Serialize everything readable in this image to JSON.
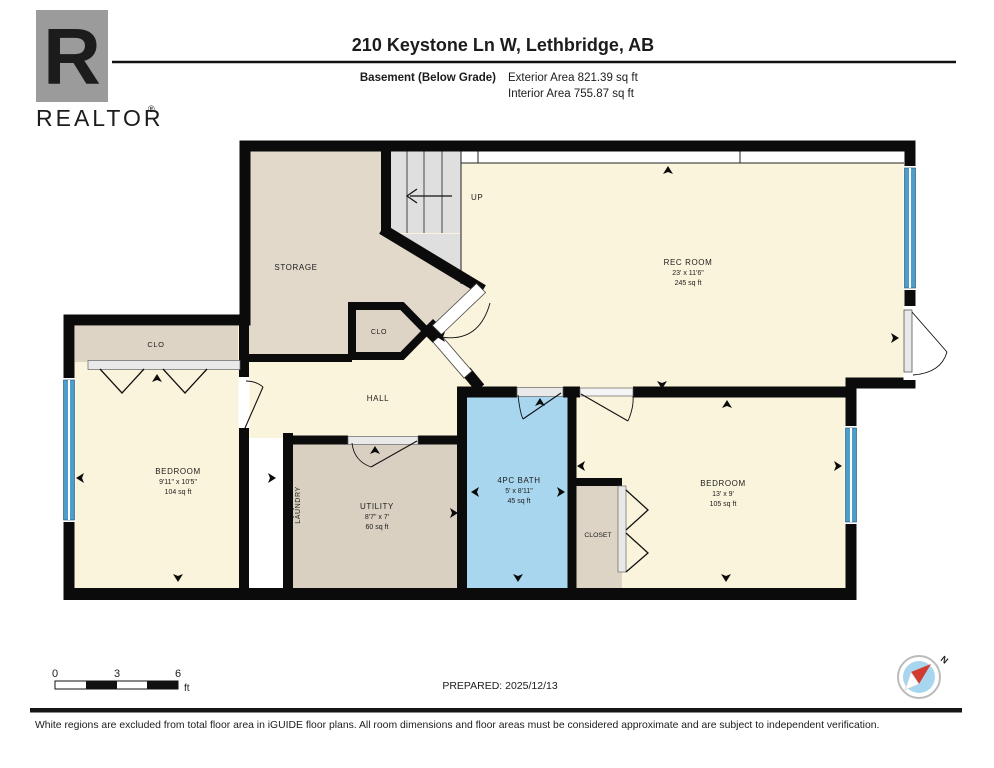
{
  "header": {
    "logo_letter": "R",
    "logo_brand": "REALTOR",
    "logo_registered": "®",
    "title": "210 Keystone Ln W, Lethbridge, AB",
    "floor_label": "Basement (Below Grade)",
    "exterior_area": "Exterior Area 821.39 sq ft",
    "interior_area": "Interior Area 755.87 sq ft"
  },
  "plan": {
    "colors": {
      "floor_cream": "#FBF4DC",
      "room_tan": "#DDD4C6",
      "bath_blue": "#A9D6EF",
      "stair_gray": "#DFDFDF",
      "window_blue": "#4D9ECD",
      "wall_black": "#0B0B0B"
    },
    "rooms": {
      "storage": {
        "name": "STORAGE"
      },
      "rec_room": {
        "name": "REC ROOM",
        "dims": "23' x 11'6\"",
        "area": "245 sq ft"
      },
      "clo_left": {
        "name": "CLO"
      },
      "clo_hall": {
        "name": "CLO"
      },
      "hall": {
        "name": "HALL"
      },
      "bedroom_left": {
        "name": "BEDROOM",
        "dims": "9'11\" x 10'5\"",
        "area": "104 sq ft"
      },
      "laundry": {
        "name": "LAUNDRY"
      },
      "utility": {
        "name": "UTILITY",
        "dims": "8'7\" x 7'",
        "area": "60 sq ft"
      },
      "bath": {
        "name": "4PC BATH",
        "dims": "5' x 8'11\"",
        "area": "45 sq ft"
      },
      "closet": {
        "name": "CLOSET"
      },
      "bedroom_right": {
        "name": "BEDROOM",
        "dims": "13' x 9'",
        "area": "105 sq ft"
      },
      "stairs": {
        "label": "UP"
      }
    }
  },
  "footer": {
    "scale": {
      "tick0": "0",
      "tick3": "3",
      "tick6": "6",
      "unit": "ft"
    },
    "prepared": "PREPARED: 2025/12/13",
    "compass_north": "N",
    "disclaimer": "White regions are excluded from total floor area in iGUIDE floor plans. All room dimensions and floor areas must be considered approximate and are subject to independent verification."
  }
}
